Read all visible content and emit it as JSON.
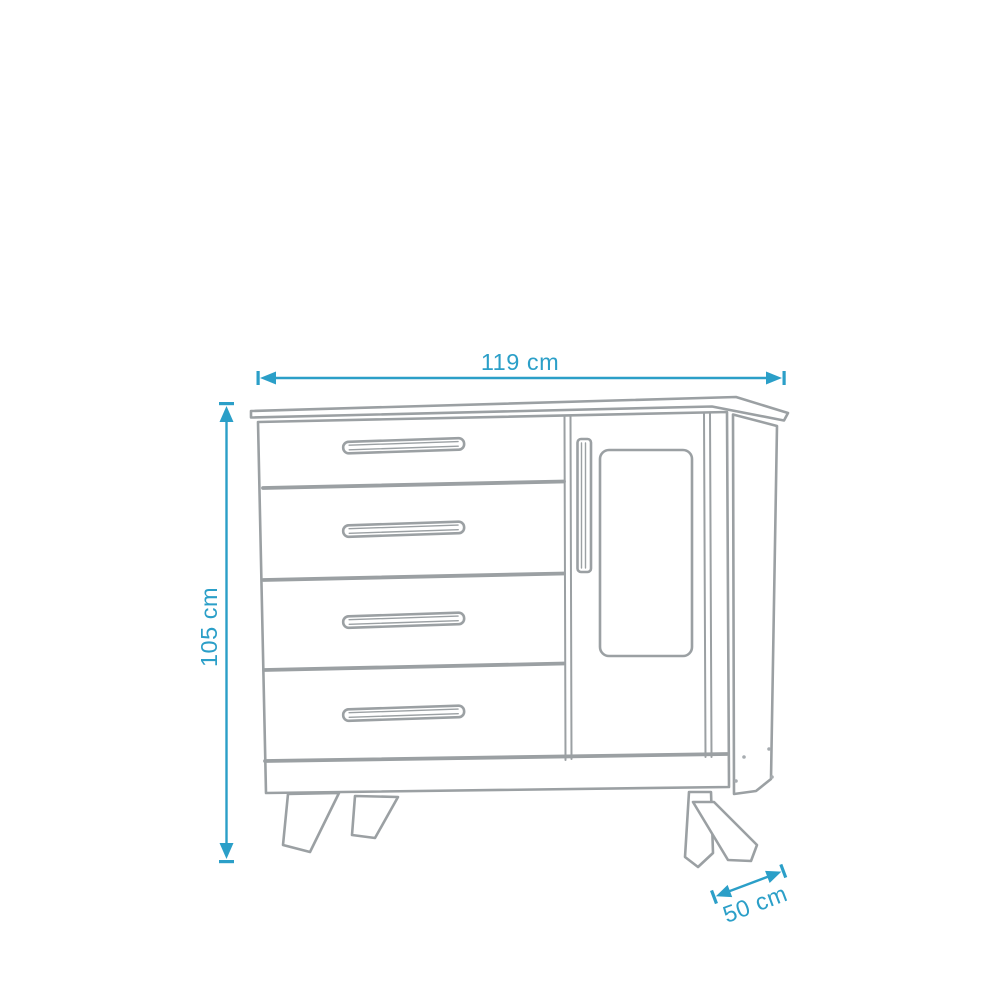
{
  "diagram": {
    "type": "furniture-dimension-diagram",
    "subject": "chest-of-drawers-with-door",
    "drawer_count": 4,
    "door_count": 1,
    "colors": {
      "dimension_accent": "#2b9fc8",
      "furniture_outline": "#9ba0a3",
      "background": "#ffffff"
    },
    "dimensions": {
      "width": {
        "label": "119 cm"
      },
      "height": {
        "label": "105 cm"
      },
      "depth": {
        "label": "50 cm"
      }
    }
  }
}
